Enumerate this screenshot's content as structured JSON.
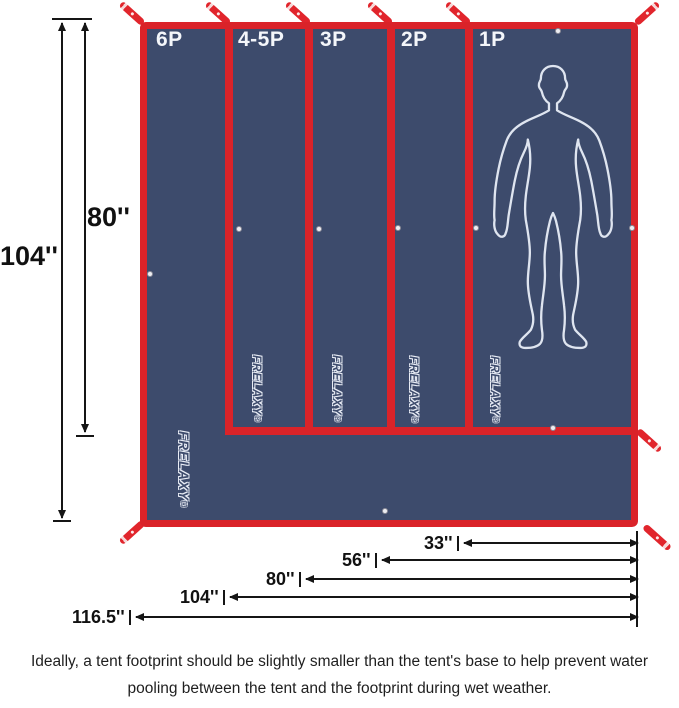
{
  "tarp": {
    "panels": [
      {
        "label": "6P"
      },
      {
        "label": "4-5P"
      },
      {
        "label": "3P"
      },
      {
        "label": "2P"
      },
      {
        "label": "1P"
      }
    ],
    "brand": "FRELAXY",
    "registered": "®"
  },
  "dimensions": {
    "height_total": "104''",
    "height_inner": "80''",
    "widths": [
      {
        "label": "33''"
      },
      {
        "label": "56''"
      },
      {
        "label": "80''"
      },
      {
        "label": "104''"
      },
      {
        "label": "116.5''"
      }
    ]
  },
  "caption": {
    "line1": "Ideally, a tent footprint should be slightly smaller than the tent's base to help prevent water",
    "line2": "pooling between the tent and the footprint during wet weather."
  },
  "colors": {
    "tarp_navy": "#3d4b6c",
    "tarp_red": "#da2329",
    "arrow_black": "#151515",
    "outline_white": "#e8ecf5"
  }
}
